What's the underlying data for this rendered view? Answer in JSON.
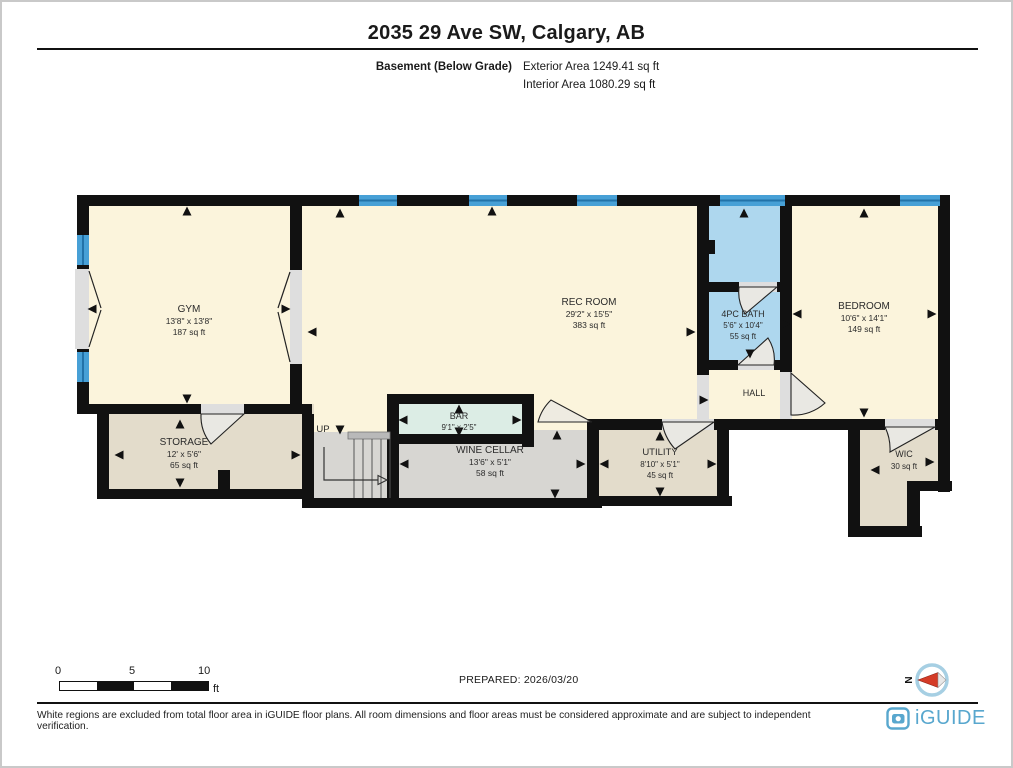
{
  "header": {
    "title": "2035 29 Ave SW, Calgary, AB",
    "floor_label": "Basement (Below Grade)",
    "exterior_area": "Exterior Area 1249.41 sq ft",
    "interior_area": "Interior Area 1080.29 sq ft"
  },
  "rooms": {
    "gym": {
      "name": "GYM",
      "dims": "13'8\" x 13'8\"",
      "area": "187 sq ft"
    },
    "rec_room": {
      "name": "REC ROOM",
      "dims": "29'2\" x 15'5\"",
      "area": "383 sq ft"
    },
    "bath": {
      "name": "4PC BATH",
      "dims": "5'6\" x 10'4\"",
      "area": "55 sq ft"
    },
    "bedroom": {
      "name": "BEDROOM",
      "dims": "10'6\" x 14'1\"",
      "area": "149 sq ft"
    },
    "hall": {
      "name": "HALL"
    },
    "storage": {
      "name": "STORAGE",
      "dims": "12' x 5'6\"",
      "area": "65 sq ft"
    },
    "bar": {
      "name": "BAR",
      "dims": "9'1\" x 2'5\""
    },
    "wine_cellar": {
      "name": "WINE CELLAR",
      "dims": "13'6\" x 5'1\"",
      "area": "58 sq ft"
    },
    "utility": {
      "name": "UTILITY",
      "dims": "8'10\" x 5'1\"",
      "area": "45 sq ft"
    },
    "wic": {
      "name": "WIC",
      "area": "30 sq ft"
    },
    "stairs": {
      "label": "UP"
    }
  },
  "scale_bar": {
    "t0": "0",
    "t5": "5",
    "t10": "10",
    "unit": "ft"
  },
  "footer": {
    "prepared": "PREPARED: 2026/03/20",
    "disclaimer": "White regions are excluded from total floor area in iGUIDE floor plans. All room dimensions and floor areas must be considered approximate and are subject to independent verification.",
    "brand": "iGUIDE",
    "compass_n": "N"
  },
  "colors": {
    "wall": "#111111",
    "room_cream": "#fbf4dc",
    "bath_blue": "#aed7ee",
    "window_blue": "#47a0d6",
    "window_line": "#2272a8",
    "bar_mint": "#dcede5",
    "gray_floor": "#d7d6d2",
    "beige_floor": "#e3dccb",
    "brand_blue": "#58a7ce",
    "compass_red": "#d43b27"
  }
}
